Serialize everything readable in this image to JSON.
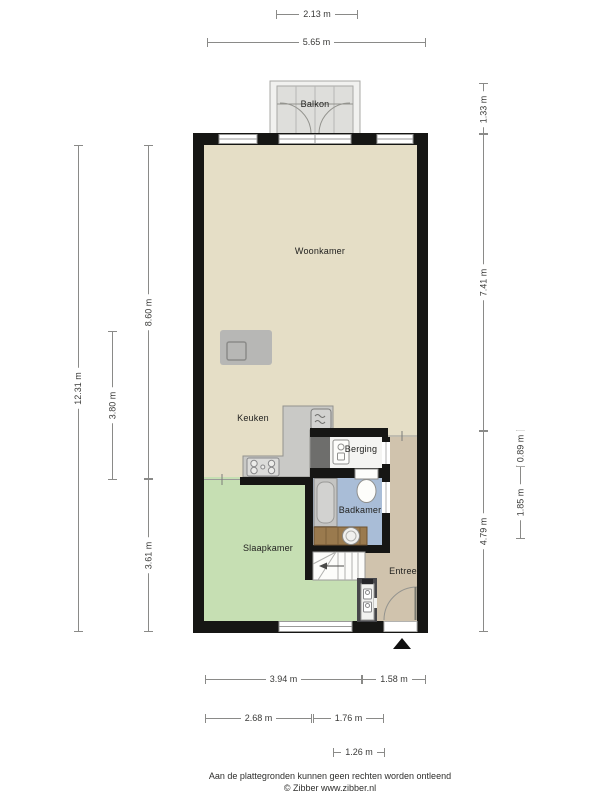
{
  "rooms": {
    "balkon": "Balkon",
    "woonkamer": "Woonkamer",
    "keuken": "Keuken",
    "berging": "Berging",
    "badkamer": "Badkamer",
    "slaapkamer": "Slaapkamer",
    "entree": "Entree"
  },
  "dimensions": {
    "top": [
      {
        "label": "2.13 m"
      },
      {
        "label": "5.65 m"
      }
    ],
    "left": [
      {
        "label": "12.31 m"
      },
      {
        "label": "8.60 m"
      },
      {
        "label": "3.80 m"
      },
      {
        "label": "3.61 m"
      }
    ],
    "right": [
      {
        "label": "1.33 m"
      },
      {
        "label": "7.41 m"
      },
      {
        "label": "4.79 m"
      },
      {
        "label": "0.89 m"
      },
      {
        "label": "1.85 m"
      }
    ],
    "bottom": [
      {
        "label": "3.94 m"
      },
      {
        "label": "1.58 m"
      },
      {
        "label": "2.68 m"
      },
      {
        "label": "1.76 m"
      },
      {
        "label": "1.26 m"
      }
    ]
  },
  "footer": {
    "disclaimer": "Aan de plattegronden kunnen geen rechten worden ontleend",
    "credit": "© Zibber www.zibber.nl"
  },
  "icons": {
    "entrance-marker": "▲ filled triangle below front door",
    "stove": "4-burner cooktop",
    "washing-machine": "square with wave lines",
    "boiler": "storage water heater",
    "toilet": "tank + bowl",
    "bathtub": "rounded tub",
    "sink": "round basin on wooden vanity",
    "meters": "utility meters in cupboard"
  },
  "colors": {
    "wall": "#161614",
    "floor_living": "#e5dec6",
    "floor_bedroom": "#c6dfb3",
    "floor_bathroom": "#a9bdd7",
    "floor_hall": "#d0c3ad",
    "floor_storage": "#f4f4f2",
    "balcony_deck": "#dededb",
    "dimension_line": "#8a8a88"
  }
}
